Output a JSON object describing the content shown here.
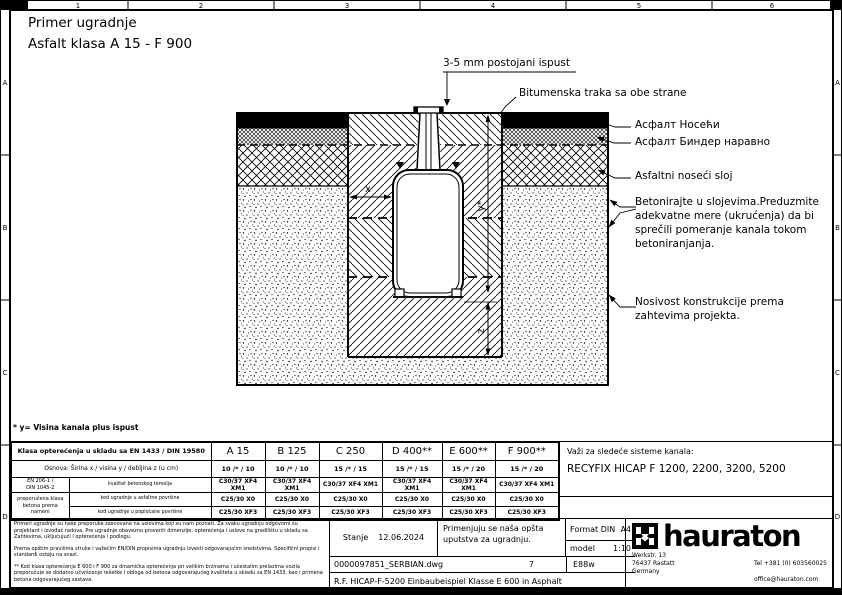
{
  "sheet": {
    "title_line1": "Primer ugradnje",
    "title_line2": "Asfalt klasa A 15 - F 900",
    "ruler_cols": [
      "1",
      "2",
      "3",
      "4",
      "5",
      "6"
    ],
    "ruler_rows": [
      "A",
      "B",
      "C",
      "D"
    ]
  },
  "annotations": {
    "ispust": "3-5 mm postojani ispust",
    "bitumen": "Bitumenska traka sa obe strane",
    "asfalt_noseci": "Асфалт Носећи",
    "asfalt_binder": "Асфалт Биндер наравно",
    "asfaltni_sloj": "Asfaltni noseći sloj",
    "betonirajte": "Betonirajte u slojevima.Preduzmite\nadekvatne mere (ukrućenja) da bi\nsprečili pomeranje kanala tokom\nbetoniranjanja.",
    "nosivost": "Nosivost konstrukcije prema\nzahtevima projekta.",
    "dim_x": "x",
    "dim_y": "y*",
    "dim_z": "z"
  },
  "footnote": "* y= Visina kanala plus ispust",
  "table": {
    "header_label": "Klasa opterećenja u skladu sa EN 1433 / DIN 19580",
    "col_headers": [
      "A 15",
      "B 125",
      "C 250",
      "D 400**",
      "E 600**",
      "F 900**"
    ],
    "osnova_label": "Osnova: Širina x / visina y / debljina z (u cm)",
    "osnova_values": [
      "10 /* / 10",
      "10 /* / 10",
      "15 /* / 15",
      "15 /* / 15",
      "15 /* / 20",
      "15 /* / 20"
    ],
    "norm": "EN 206-1 /\nDIN 1045-2",
    "norm_note": "preporučena klasa\nbetona prema nameni",
    "rows": [
      {
        "label": "kvalitet betonskog temelja",
        "values": [
          "C30/37 XF4 XM1",
          "C30/37 XF4 XM1",
          "C30/37 XF4 XM1",
          "C30/37 XF4 XM1",
          "C30/37 XF4 XM1",
          "C30/37 XF4 XM1"
        ]
      },
      {
        "label": "kod ugradnje u asfaltne površine",
        "values": [
          "C25/30 X0",
          "C25/30 X0",
          "C25/30 X0",
          "C25/30 X0",
          "C25/30 X0",
          "C25/30 X0"
        ]
      },
      {
        "label": "kod ugradnje u popločane površine",
        "values": [
          "C25/30 XF3",
          "C25/30 XF3",
          "C25/30 XF3",
          "C25/30 XF3",
          "C25/30 XF3",
          "C25/30 XF3"
        ]
      }
    ]
  },
  "valid_for": {
    "label": "Važi za sledeće sisteme kanala:",
    "systems": "RECYFIX HICAP F 1200, 2200, 3200, 5200"
  },
  "titleblock": {
    "disclaimer_p1": "Primeri ugradnje su naše preporuke zasnovane na uslovima koji su nam poznati. Za svaku ugradnju odgovorni su projektant i izvođač radova. Pre ugradnje obavezno proveriti dimenzije, opterećenja i uslove na gradilištu u skladu sa Zahtevima, uključujući i opterećenja i podlogu.",
    "disclaimer_p2": "Prema opštim pravilima struke i važećim EN/DIN propisima ugradnju izvesti odgovarajućim sredstvima. Specifični propisi i standardi ostaju na snazi.",
    "disclaimer_p3": "** Kod klasa opterećenja E 600 i F 900 za dinamička opterećenja pri velikim brzinama i učestalim prelazima vozila preporučuje se dodatno učvršćenje rešetke i obloga od betona odgovarajućeg kvaliteta u skladu sa EN 1433, kao i primena betona odgovarajućeg sastava.",
    "status_label": "Stanje",
    "status_date": "12.06.2024",
    "note": "Primenjuju se naša opšta\nuputstva za ugradnju.",
    "format_label": "Format DIN",
    "format_value": "A4",
    "scale_label": "model",
    "scale_value": "1:10",
    "file_name": "0000097851_SERBIAN.dwg",
    "sheet_no": "7",
    "code": "E88w",
    "drawing_title": "R.F. HICAP-F-5200 Einbaubeispiel Klasse E 600 in Asphalt",
    "brand": "hauraton",
    "address": "Werkstr. 13\n76437 Rastatt\nGermany",
    "phone": "Tel +381 (0) 603560025",
    "email": "office@hauraton.com"
  }
}
